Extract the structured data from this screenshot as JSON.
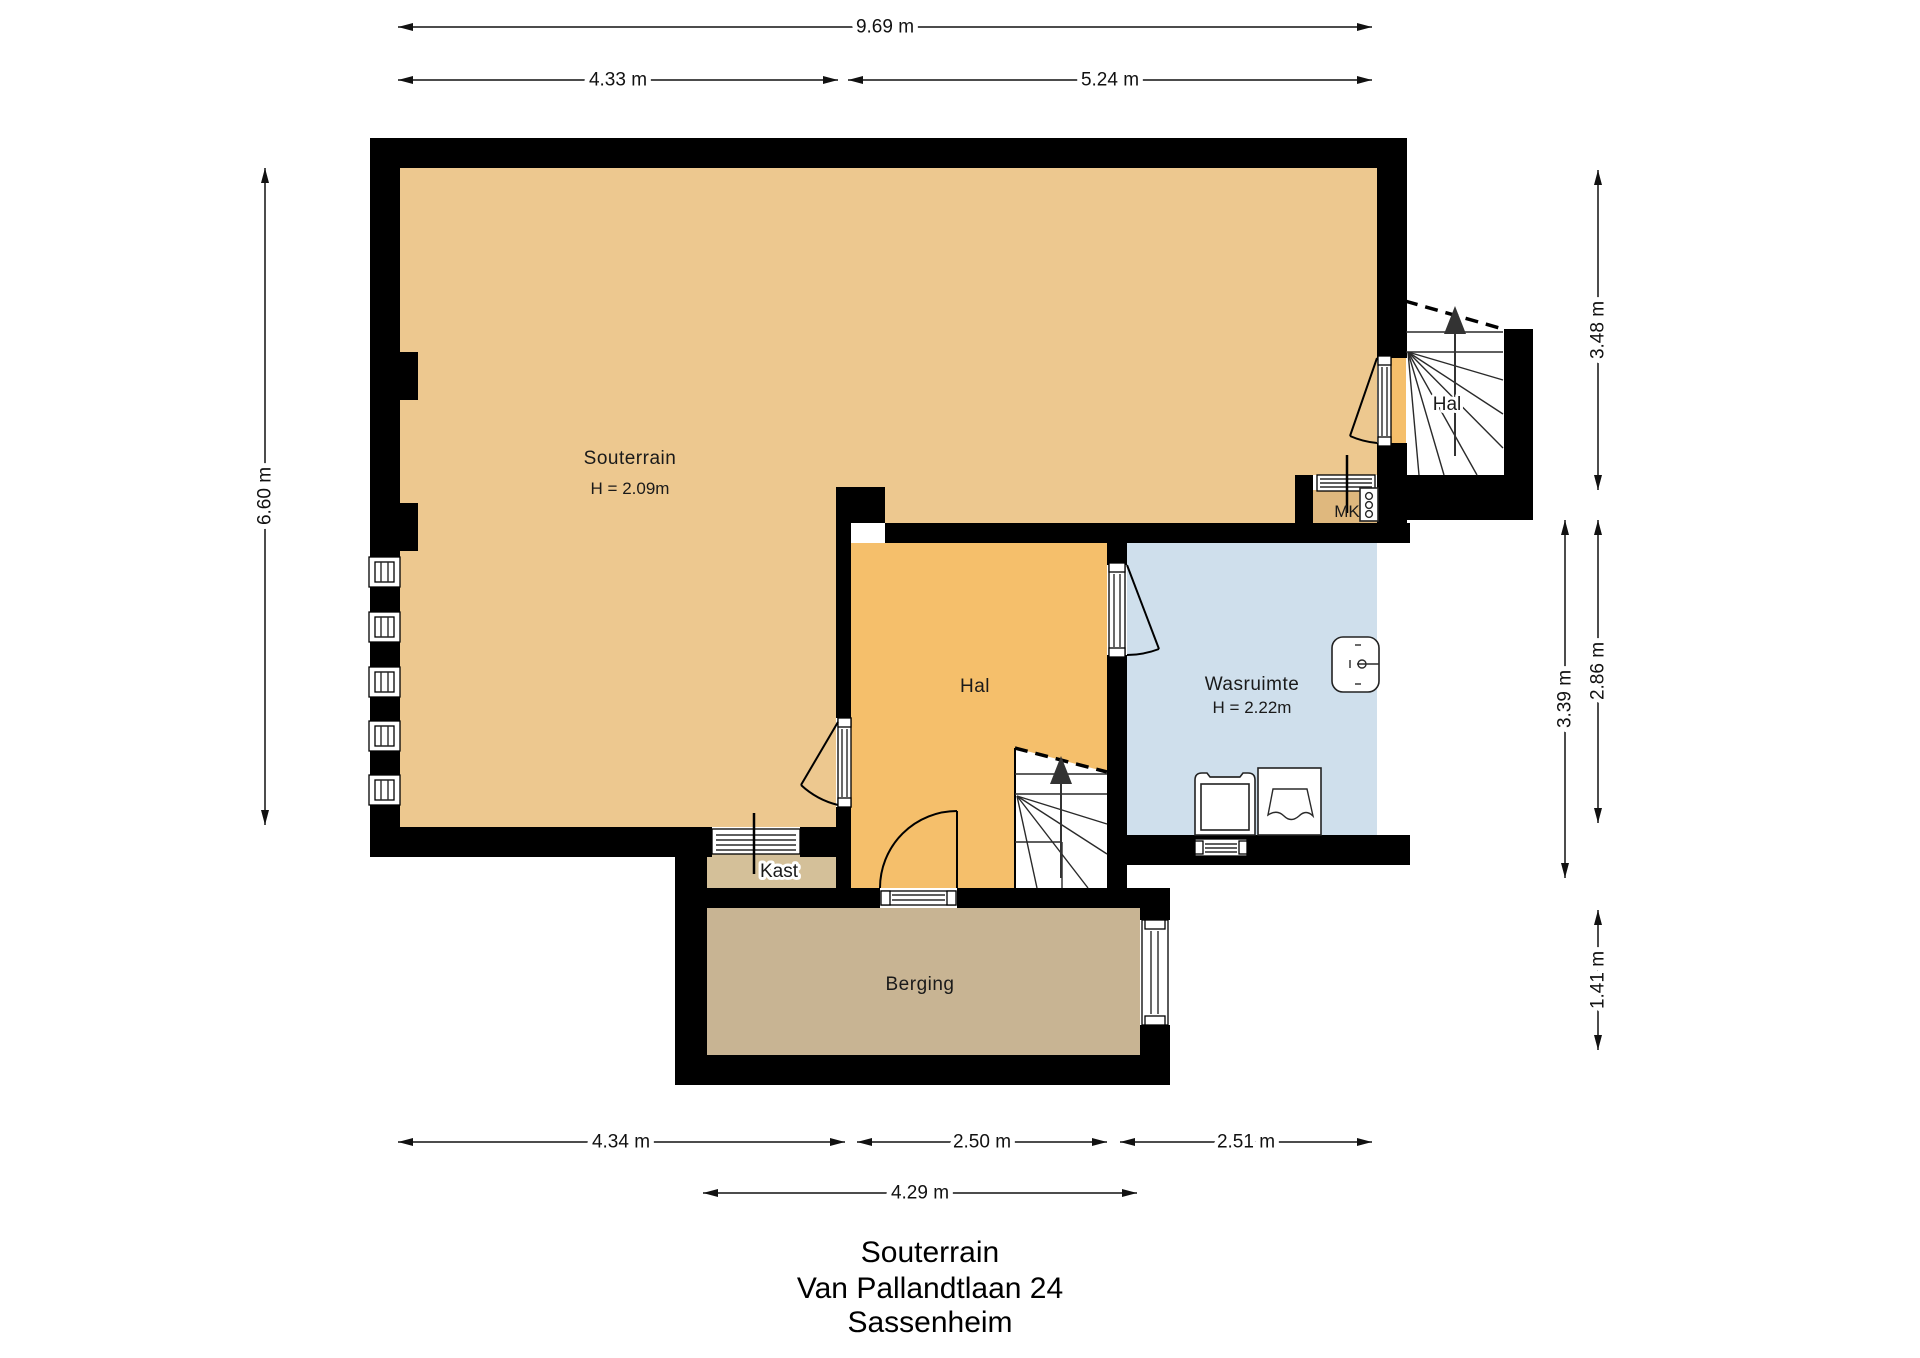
{
  "title": {
    "lines": [
      "Souterrain",
      "Van Pallandtlaan 24",
      "Sassenheim"
    ]
  },
  "rooms": {
    "souterrain": {
      "label": "Souterrain",
      "height": "H = 2.09m",
      "color": "#edc88f"
    },
    "hal_center": {
      "label": "Hal",
      "color": "#f5bf6b"
    },
    "hal_upper": {
      "label": "Hal",
      "color": "#f5bf6b"
    },
    "wasruimte": {
      "label": "Wasruimte",
      "height": "H = 2.22m",
      "color": "#cfdfec"
    },
    "kast": {
      "label": "Kast",
      "color": "#d4c099"
    },
    "berging": {
      "label": "Berging",
      "color": "#c8b493"
    },
    "mk": {
      "label": "MK",
      "color": "#dfb87e"
    }
  },
  "dimensions": {
    "top_total": "9.69 m",
    "top_left": "4.33 m",
    "top_right": "5.24 m",
    "left_total": "6.60 m",
    "right_top": "3.48 m",
    "right_middle_outer": "2.86 m",
    "right_middle_inner": "3.39 m",
    "right_bottom": "1.41 m",
    "bottom_left": "4.34 m",
    "bottom_middle": "2.50 m",
    "bottom_right": "2.51 m",
    "bottom_total": "4.29 m"
  },
  "colors": {
    "wall": "#000000",
    "background": "#ffffff",
    "lines": "#111111"
  }
}
